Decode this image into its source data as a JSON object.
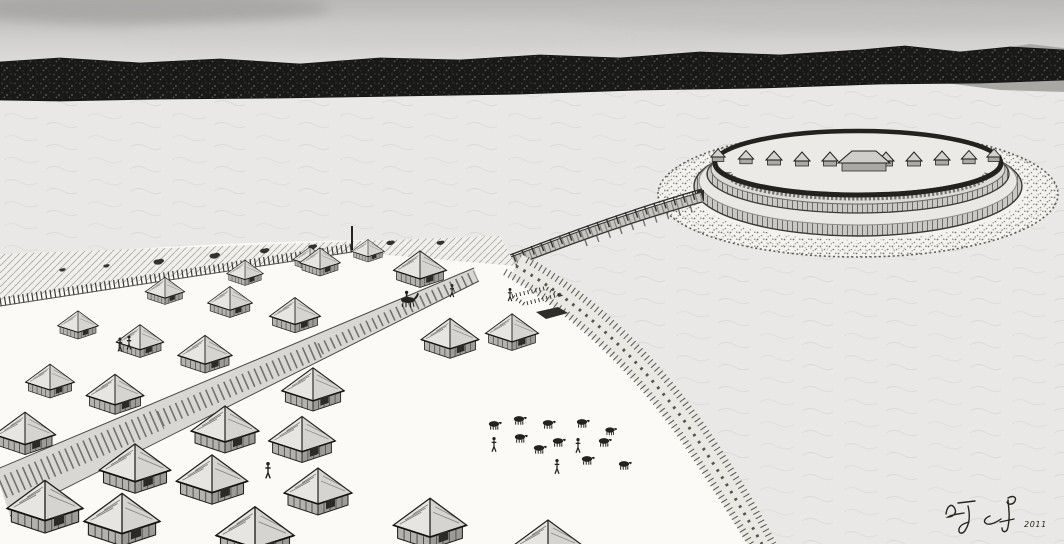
{
  "image": {
    "type": "illustration",
    "medium": "black-and-white pen reconstruction drawing",
    "caption": "Lakeside settlement with thatched huts, timber plank road, wooden causeway bridge and circular fortified island with double palisade rings",
    "visible_text": [
      "2011"
    ]
  },
  "signature": {
    "label": "artist handwritten signature",
    "year": "2011"
  },
  "palette": {
    "sky_top": "#b9b8b6",
    "sky_bottom": "#efeeec",
    "forest": "#191917",
    "water": "#e9e8e6",
    "ground": "#fbfaf7",
    "ink": "#23221f",
    "roof_light": "#e6e5e1",
    "wall_wood": "#b3b2ae"
  },
  "scene": {
    "counts": {
      "village_huts": 27,
      "fort_huts": 11,
      "cattle": 11,
      "people": 8,
      "horse_riders": 1
    },
    "elements": [
      "sky",
      "forest-treeline",
      "lake-water",
      "ring-fortress",
      "causeway-bridge",
      "plank-road",
      "village-huts",
      "palisade",
      "shoreline-embankment",
      "cattle-herd",
      "artist-signature"
    ]
  }
}
